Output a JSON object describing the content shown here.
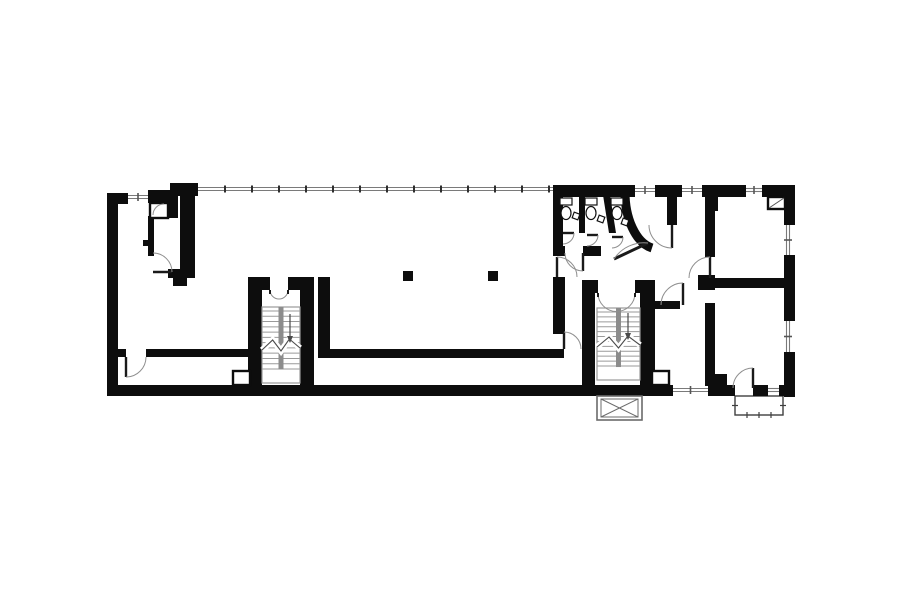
{
  "meta": {
    "canvas": {
      "w": 900,
      "h": 604
    },
    "colors": {
      "background": "#ffffff",
      "wall": "#0d0d0d",
      "window_line": "#7a7a7a",
      "stair_line": "#9a9a9a",
      "stair_stringer": "#8c8c8c",
      "door_arc": "#8f8f8f",
      "door_leaf": "#1a1a1a",
      "fixture_line": "#111111",
      "detail_line": "#555555"
    }
  },
  "plan": {
    "walls": [
      [
        107,
        193,
        21,
        11
      ],
      [
        107,
        193,
        11,
        203
      ],
      [
        107,
        385,
        566,
        11
      ],
      [
        148,
        190,
        25,
        13
      ],
      [
        170,
        183,
        28,
        13
      ],
      [
        168,
        196,
        10,
        22
      ],
      [
        553,
        185,
        82,
        12
      ],
      [
        655,
        185,
        27,
        12
      ],
      [
        702,
        185,
        44,
        12
      ],
      [
        707,
        197,
        11,
        14
      ],
      [
        762,
        185,
        33,
        12
      ],
      [
        784,
        192,
        11,
        33
      ],
      [
        784,
        255,
        11,
        66
      ],
      [
        784,
        352,
        11,
        45
      ],
      [
        708,
        385,
        27,
        11
      ],
      [
        753,
        385,
        15,
        11
      ],
      [
        779,
        385,
        16,
        11
      ],
      [
        180,
        190,
        15,
        88
      ],
      [
        168,
        269,
        27,
        9
      ],
      [
        173,
        278,
        14,
        8
      ],
      [
        148,
        216,
        6,
        26
      ],
      [
        143,
        240,
        11,
        6
      ],
      [
        148,
        246,
        6,
        10
      ],
      [
        553,
        197,
        10,
        59
      ],
      [
        553,
        246,
        12,
        10
      ],
      [
        583,
        246,
        18,
        10
      ],
      [
        579,
        195,
        6,
        38
      ],
      [
        553,
        277,
        12,
        57
      ],
      [
        550,
        349,
        14,
        9
      ],
      [
        318,
        277,
        12,
        81
      ],
      [
        318,
        349,
        234,
        9
      ],
      [
        118,
        349,
        8,
        8
      ],
      [
        146,
        349,
        104,
        8
      ],
      [
        248,
        277,
        14,
        109
      ],
      [
        300,
        277,
        14,
        109
      ],
      [
        248,
        277,
        22,
        13
      ],
      [
        288,
        277,
        26,
        13
      ],
      [
        582,
        280,
        13,
        106
      ],
      [
        640,
        280,
        15,
        106
      ],
      [
        582,
        280,
        16,
        13
      ],
      [
        635,
        280,
        20,
        13
      ],
      [
        667,
        197,
        10,
        28
      ],
      [
        705,
        197,
        10,
        60
      ],
      [
        698,
        275,
        17,
        15
      ],
      [
        712,
        278,
        72,
        10
      ],
      [
        705,
        303,
        10,
        83
      ],
      [
        648,
        301,
        32,
        8
      ],
      [
        713,
        374,
        14,
        11
      ]
    ],
    "columns": [
      [
        403,
        271,
        10,
        10
      ],
      [
        488,
        271,
        10,
        10
      ]
    ],
    "slanted_walls": [
      [
        [
          603,
          195
        ],
        [
          610,
          195
        ],
        [
          616,
          233
        ],
        [
          609,
          233
        ]
      ]
    ],
    "white_insets": [
      {
        "r": [
          233,
          371,
          17,
          14
        ]
      },
      {
        "r": [
          652,
          371,
          17,
          14
        ]
      },
      {
        "r": [
          768,
          197,
          17,
          12
        ],
        "diag": [
          [
            769,
            208
          ],
          [
            784,
            198
          ]
        ]
      },
      {
        "r": [
          150,
          203,
          18,
          15
        ],
        "arc": "M153,215 A11,11 0 0 1 164,204"
      }
    ],
    "windows": [
      {
        "x1": 128,
        "y1": 197,
        "x2": 148,
        "y2": 197,
        "tick": true
      },
      {
        "x1": 198,
        "y1": 189,
        "x2": 553,
        "y2": 189,
        "tick": false,
        "mullions": {
          "from": 225,
          "to": 549,
          "step": 27
        }
      },
      {
        "x1": 635,
        "y1": 190,
        "x2": 655,
        "y2": 190,
        "tick": true
      },
      {
        "x1": 682,
        "y1": 190,
        "x2": 702,
        "y2": 190,
        "tick": true
      },
      {
        "x1": 746,
        "y1": 190,
        "x2": 762,
        "y2": 190,
        "tick": true
      },
      {
        "x1": 788,
        "y1": 225,
        "x2": 788,
        "y2": 255,
        "tick": true
      },
      {
        "x1": 788,
        "y1": 321,
        "x2": 788,
        "y2": 352,
        "tick": true
      },
      {
        "x1": 673,
        "y1": 390,
        "x2": 708,
        "y2": 390,
        "tick": true
      },
      {
        "x1": 768,
        "y1": 390,
        "x2": 779,
        "y2": 390,
        "tick": false
      }
    ],
    "doors": [
      {
        "h": [
          153,
          272
        ],
        "r": 19,
        "leaf": 0,
        "end": 270
      },
      {
        "h": [
          126,
          357
        ],
        "r": 20,
        "leaf": 90,
        "end": 0
      },
      {
        "h": [
          583,
          253
        ],
        "r": 18,
        "leaf": 90,
        "end": 180
      },
      {
        "h": [
          557,
          277
        ],
        "r": 20,
        "leaf": 270,
        "end": 0
      },
      {
        "h": [
          564,
          349
        ],
        "r": 17,
        "leaf": 270,
        "end": 0
      },
      {
        "h": [
          672,
          225
        ],
        "r": 23,
        "leaf": 90,
        "end": 180
      },
      {
        "h": [
          710,
          278
        ],
        "r": 21,
        "leaf": 270,
        "end": 180
      },
      {
        "h": [
          683,
          305
        ],
        "r": 22,
        "leaf": 270,
        "end": 180
      },
      {
        "h": [
          753,
          388
        ],
        "r": 20,
        "leaf": 270,
        "end": 180
      },
      {
        "h": [
          563,
          233
        ],
        "r": 11,
        "leaf": 0,
        "end": 90
      },
      {
        "h": [
          587,
          235
        ],
        "r": 11,
        "leaf": 0,
        "end": 90
      },
      {
        "h": [
          612,
          237
        ],
        "r": 11,
        "leaf": 0,
        "end": 90
      }
    ],
    "double_doors": [
      {
        "x1": 270,
        "x2": 288,
        "y": 290
      },
      {
        "x1": 598,
        "x2": 635,
        "y": 293
      }
    ],
    "stairs": [
      {
        "x": 262,
        "y": 307,
        "w": 38,
        "h": 76,
        "treads": 11,
        "arrow_x": 290,
        "ay1": 314,
        "ay2": 342,
        "break_y": 345
      },
      {
        "x": 597,
        "y": 308,
        "w": 43,
        "h": 72,
        "treads": 11,
        "arrow_x": 628,
        "ay1": 313,
        "ay2": 339,
        "break_y": 342
      }
    ],
    "elevator": {
      "x": 597,
      "y": 396,
      "w": 45,
      "h": 24
    },
    "balcony": {
      "x": 735,
      "y": 396,
      "w": 48,
      "h": 19
    },
    "toilets": [
      {
        "cx": 566,
        "y": 198
      },
      {
        "cx": 591,
        "y": 198
      },
      {
        "cx": 617,
        "y": 198
      }
    ],
    "dispensers": [
      {
        "x": 573,
        "y": 213,
        "rot": 20
      },
      {
        "x": 598,
        "y": 216,
        "rot": 20
      },
      {
        "x": 622,
        "y": 219,
        "rot": 20
      }
    ],
    "curved_wall": {
      "path": "M625,191 A33,57 0 0 0 652,248",
      "width": 9
    },
    "curve_door": {
      "leaf": [
        [
          648,
          243
        ],
        [
          614,
          259
        ]
      ],
      "arc": "M614,259 A36,36 0 0 1 648,243"
    }
  }
}
